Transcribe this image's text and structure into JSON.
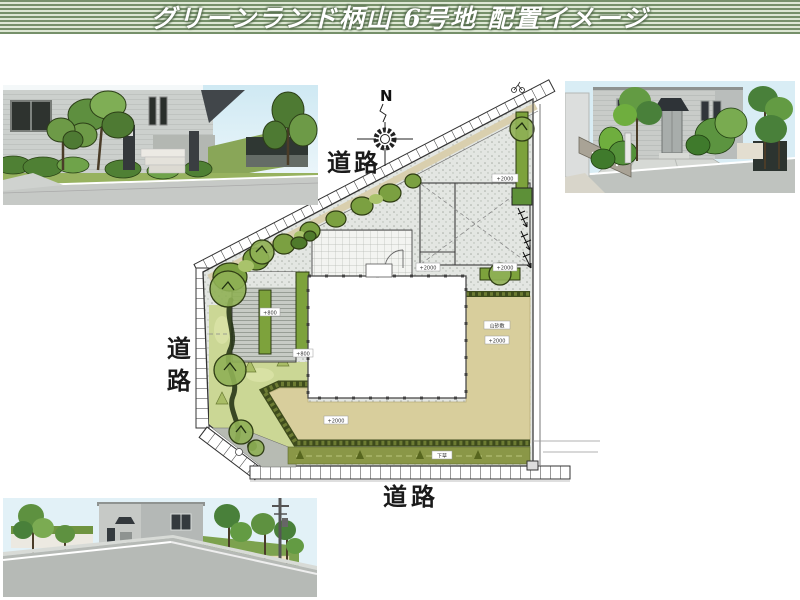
{
  "title_bar": {
    "title": "グリーンランド柄山 6号地 配置イメージ"
  },
  "site_plan": {
    "compass": "N",
    "roads": {
      "top": "道路",
      "left": "道路",
      "bottom": "道路"
    },
    "chips": [
      {
        "text": "+2000"
      },
      {
        "text": "+2000"
      },
      {
        "text": "+2000"
      },
      {
        "text": "山砂敷"
      },
      {
        "text": "+2000"
      },
      {
        "text": "+2000"
      },
      {
        "text": "下草"
      },
      {
        "text": "+800"
      },
      {
        "text": "+800"
      }
    ]
  },
  "colors": {
    "title_stripe_green": "#76906a",
    "lawn_green": "#cbd795",
    "planting_green": "#7da23c",
    "hedge_dark": "#3e4b1c",
    "sand_tan": "#d8ce9c",
    "concrete_gray": "#e3e6e2",
    "undergrowth_olive": "#8a9747"
  }
}
